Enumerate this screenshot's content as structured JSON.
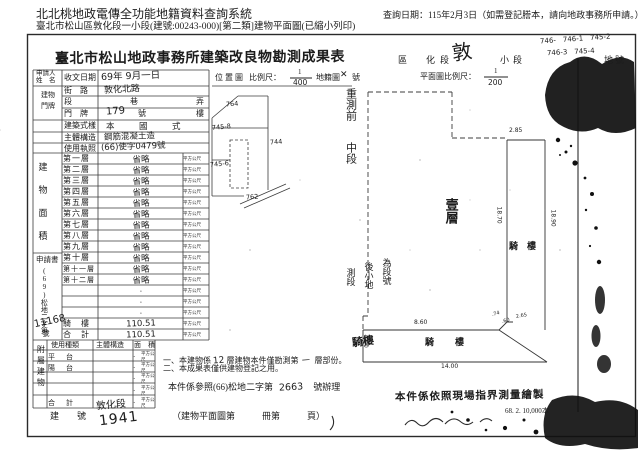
{
  "header": {
    "system_title": "北北桃地政電傳全功能地籍資料查詢系統",
    "query_date": "查詢日期：115年2月3日（如需登記謄本，請向地政事務所申請。）",
    "subtitle": "臺北市松山區敦化段一小段(建號:00243-000)[第二類]建物平面圖(已縮小列印)"
  },
  "doc": {
    "title": "臺北市松山地政事務所建築改良物勘測成果表",
    "applicant_label1": "申請人",
    "applicant_label2": "姓　名",
    "receipt_label": "收文日期",
    "receipt_value": "69年 9月一日",
    "locmap_label": "位置圖",
    "scale_label": "比例尺：",
    "scale_num": "1",
    "scale_den": "400",
    "cad_label": "地籍圖",
    "cad_value": "✕",
    "cad_suffix": "號",
    "addr_group1": "建物",
    "addr_group2": "門牌",
    "street_label": "街　路",
    "street_value": "敦化北路",
    "lane_label": "段　　巷　　弄",
    "door_label": "門　牌",
    "door_no": "179",
    "door_suffix": "號",
    "door_floor": "樓",
    "style_label": "建築式樣",
    "style_value": "本　國　式",
    "struct_label": "主體構造",
    "struct_value": "鋼筋混凝土造",
    "license_label": "使用執照",
    "license_value": "(66)使字0479號",
    "area_group": "建物面積",
    "unit": "平方公尺",
    "floors": [
      {
        "label": "第一層",
        "value": "省略"
      },
      {
        "label": "第二層",
        "value": "省略"
      },
      {
        "label": "第三層",
        "value": "省略"
      },
      {
        "label": "第四層",
        "value": "省略"
      },
      {
        "label": "第五層",
        "value": "省略"
      },
      {
        "label": "第六層",
        "value": "省略"
      },
      {
        "label": "第七層",
        "value": "省略"
      },
      {
        "label": "第八層",
        "value": "省略"
      },
      {
        "label": "第九層",
        "value": "省略"
      },
      {
        "label": "第十層",
        "value": "省略"
      },
      {
        "label": "第十一層",
        "value": "省略"
      },
      {
        "label": "第十二層",
        "value": "省略"
      },
      {
        "label": "",
        "value": "·"
      },
      {
        "label": "",
        "value": "·"
      },
      {
        "label": "",
        "value": "·"
      },
      {
        "label": "騎　樓",
        "value": "110.51"
      },
      {
        "label": "合　計",
        "value": "110.51"
      }
    ],
    "app_label": "申請書",
    "app_no_prefix": "(69)松地二字第",
    "app_no": "11168",
    "app_no_suffix": "號",
    "annex_group": "附屬建物",
    "annex_headers": [
      "使用種類",
      "主體構造",
      "面　積"
    ],
    "annex_rows": [
      {
        "label": "平　台",
        "value": "·"
      },
      {
        "label": "陽　台",
        "value": "·"
      },
      {
        "label": "",
        "value": "·"
      },
      {
        "label": "",
        "value": "·"
      },
      {
        "label": "合　計",
        "value": "·"
      }
    ],
    "notes": {
      "n1a": "一、本建物係",
      "n1hw1": "12",
      "n1b": "層建物本件僅勘測第",
      "n1hw2": "一",
      "n1c": "層部份。",
      "n1insert": "騎樓",
      "n2": "二、本成果表僅供建物登記之用。",
      "n3a": "本件係參照(66)松地二字第",
      "n3hw": "2663",
      "n3b": "號辦理",
      "n4": "本件係依照現場指界測量繪製"
    },
    "plan": {
      "loc_area": "區",
      "loc_sec": "化段",
      "loc_sec_hw": "敦",
      "loc_small": "小段",
      "loc_lot": "地號",
      "lots_hw1": "746-　746-1　745-2",
      "lots_hw2": "746-3　745-4",
      "scale_label": "平面圖比例尺：",
      "scale_num": "1",
      "scale_den": "200",
      "pre_survey": "重測前",
      "mid_sec": "中段",
      "resurvey_c1": "測段",
      "resurvey_c2": "後小地",
      "resurvey_c3": "為段號",
      "floor1": "壹層",
      "arcade_label1": "騎　樓",
      "arcade_label2": "騎　樓",
      "dims": {
        "w285": "2.85",
        "l1870": "18.70",
        "l1890": "18.90",
        "w860": "8.60",
        "w400": "4.00",
        "l1400": "14.00",
        "d74": ".74",
        "d60": ".60",
        "d265": "2.65"
      }
    },
    "posmap": {
      "lots": [
        "764",
        "745-8",
        "744",
        "745-6",
        "762"
      ]
    },
    "bottom": {
      "label": "建　　號",
      "hw_section": "敦化段",
      "hw_no": "1941",
      "book": "（建物平面圖第　　　冊第　　　頁）"
    },
    "print_code": "68. 2. 10,000本"
  }
}
